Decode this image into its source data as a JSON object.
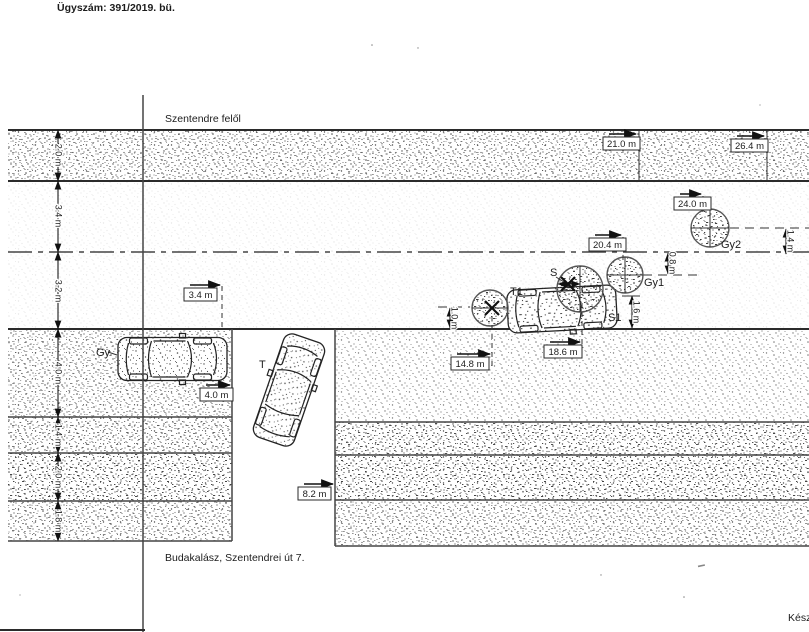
{
  "header": {
    "case_number": "Ügyszám: 391/2019. bü."
  },
  "annotations": {
    "direction": "Szentendre felől",
    "location": "Budakalász, Szentendrei út 7.",
    "footer_cut": "Kész"
  },
  "objects": {
    "vehicle_gy": "Gy",
    "vehicle_t": "T",
    "vehicle_t1": "T1",
    "point_s": "S",
    "point_s1": "S1",
    "tree_gy1": "Gy1",
    "tree_gy2": "Gy2"
  },
  "dimensions": {
    "boxed": {
      "d21_0": "21.0 m",
      "d26_4": "26.4 m",
      "d24_0": "24.0 m",
      "d20_4": "20.4 m",
      "d3_4": "3.4 m",
      "d4_0": "4.0 m",
      "d14_8": "14.8 m",
      "d18_6": "18.6 m",
      "d8_2": "8.2 m"
    },
    "left_chain": [
      "2.0 m",
      "3.4 m",
      "3.2 m",
      "4.0 m",
      "1.4 m",
      "2.0 m",
      "1.8 m"
    ],
    "offsets": {
      "v1_4": "1.4 m",
      "v0_8": "0.8 m",
      "v1_6": "1.6 m",
      "v1_0": "1.0 m"
    }
  },
  "colors": {
    "ink": "#1c1c1c",
    "line": "#4a4a4a",
    "paper": "#ffffff"
  }
}
